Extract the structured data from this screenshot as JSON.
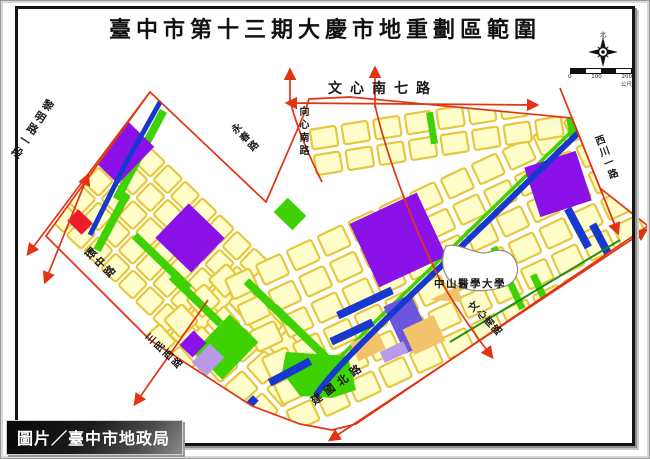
{
  "title": "臺中市第十三期大慶市地重劃區範圍",
  "credit": "圖片／臺中市地政局",
  "map": {
    "roads": {
      "wenxin_s7": "文心南七路",
      "xiangxin_s": "向心南路",
      "wenxin_s": "文心南路",
      "liming_1": "黎明路一段",
      "huanzhong": "環中路",
      "sanmin_w": "三民西路",
      "jianguo_n": "建國北路",
      "xichuan_1": "西川一路",
      "yongchun": "永春路"
    },
    "landmarks": {
      "university": "中山醫學大學"
    },
    "compass": {
      "north": "北"
    },
    "scalebar": {
      "t0": "0",
      "t1": "100",
      "t2": "200",
      "unit": "公尺"
    },
    "colors": {
      "boundary": "#e23413",
      "block_fill": "#fffdc9",
      "block_stroke": "#e5c83e",
      "purple": "#8a12e8",
      "green": "#3ed203",
      "blue": "#1837cf",
      "red_block": "#ee1b2c",
      "tan": "#f2c36b",
      "light_purple": "#b89ae8",
      "slate_purple": "#6a57dd",
      "dark_green_line": "#1d8f12"
    }
  }
}
